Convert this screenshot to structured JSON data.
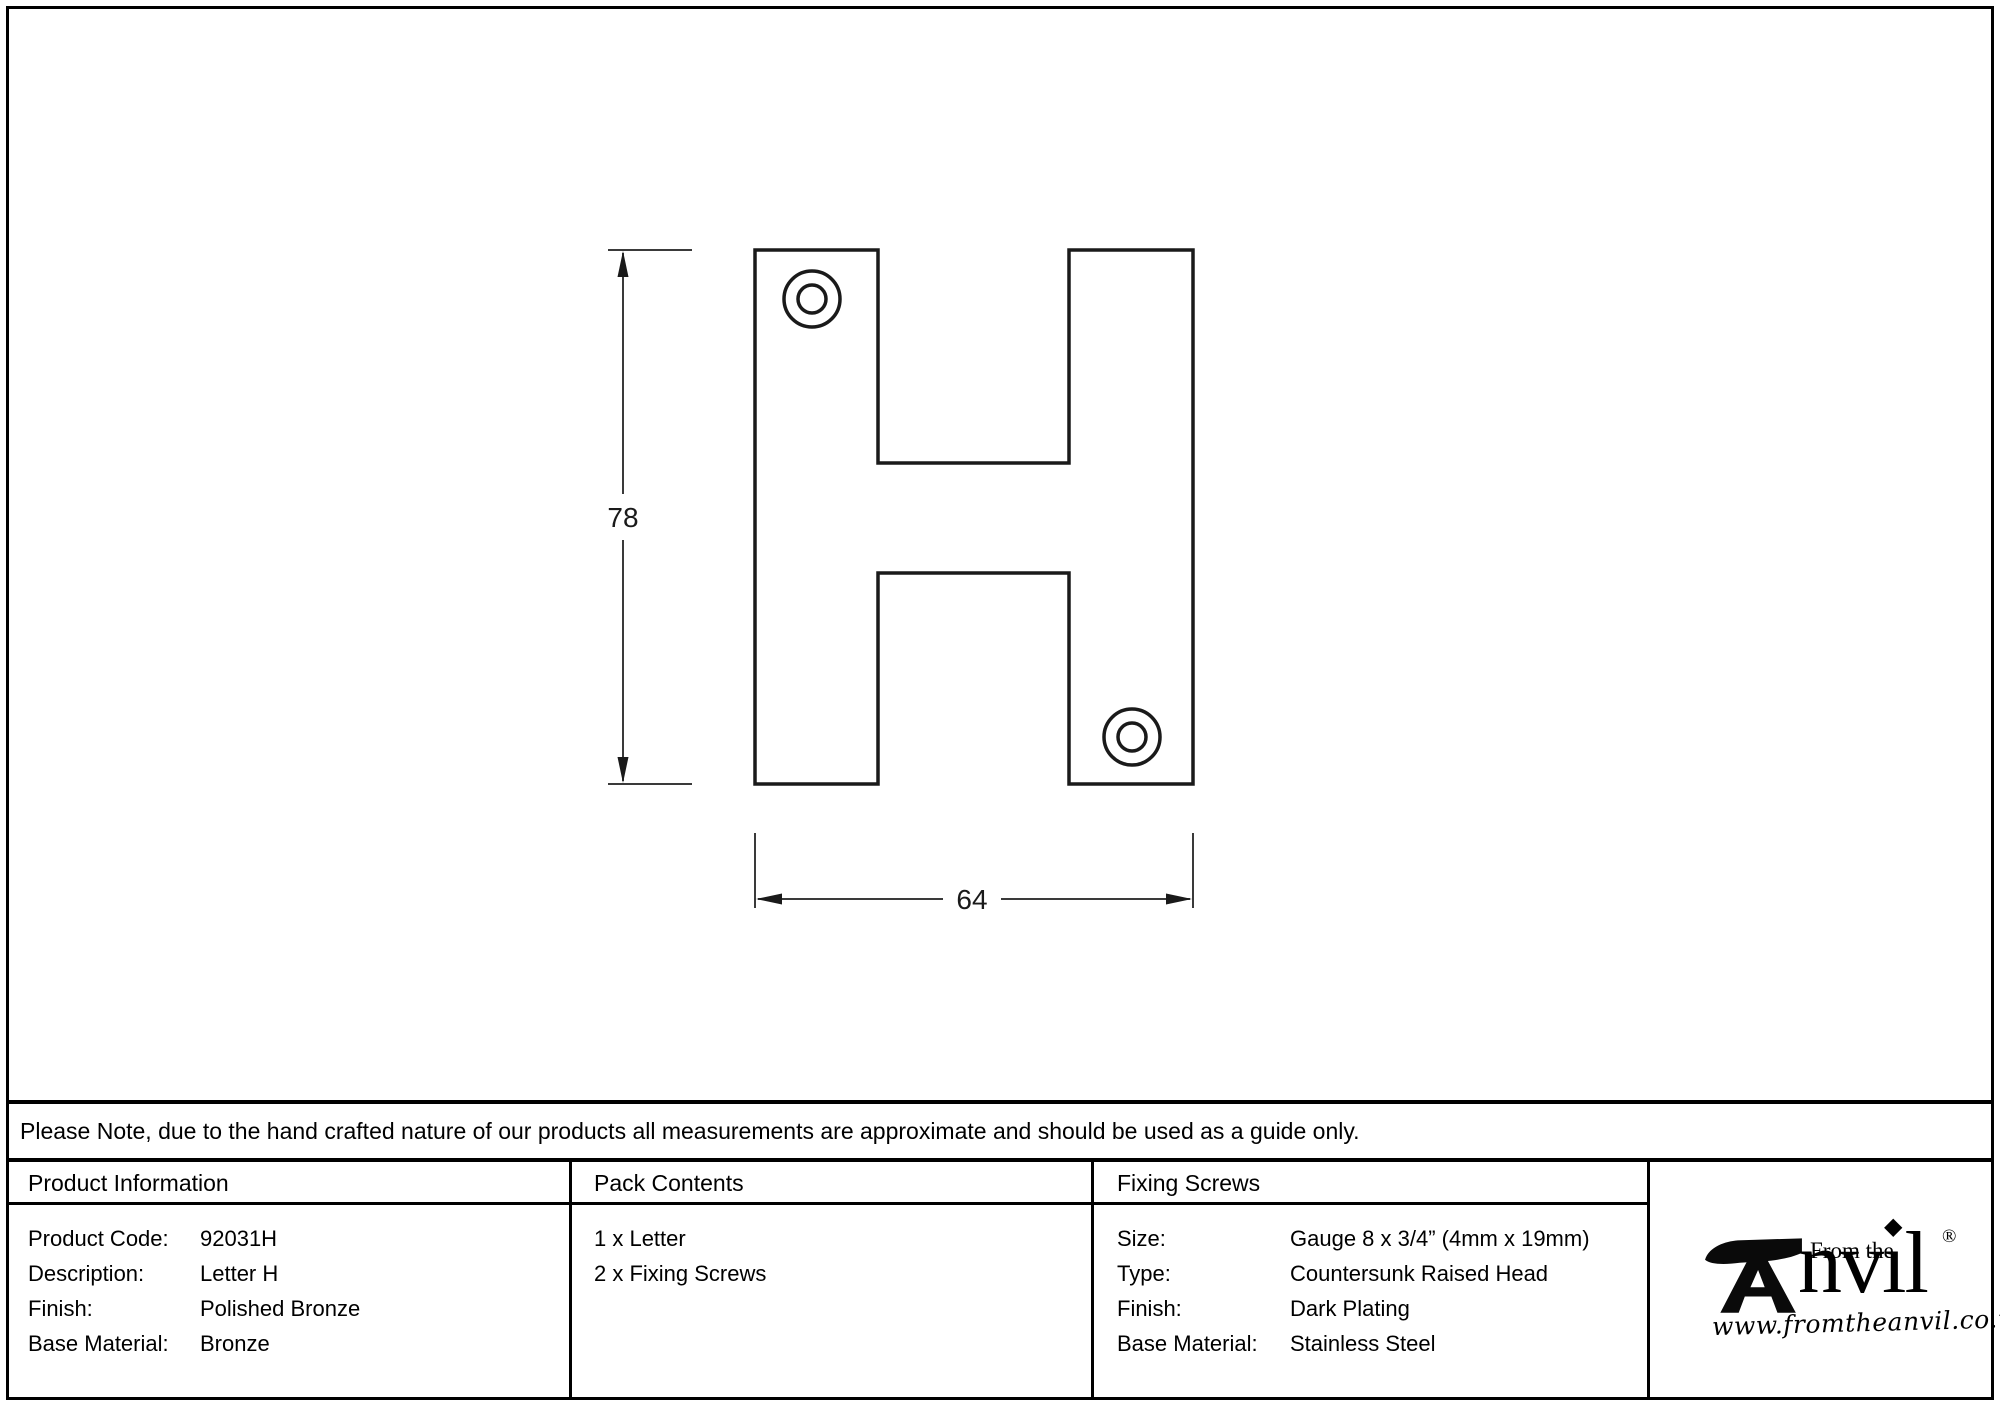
{
  "page": {
    "background": "#ffffff",
    "border_color": "#000000",
    "ink_color": "#1a1a1a"
  },
  "drawing": {
    "part": "letter-H-fascia",
    "height_dim": "78",
    "width_dim": "64",
    "screw_hole_count": 2
  },
  "note": {
    "text": "Please Note, due to the hand crafted nature of our products all measurements are approximate and should be used as a guide only."
  },
  "table": {
    "product_information": {
      "header": "Product Information",
      "rows": [
        {
          "label": "Product Code:",
          "value": "92031H"
        },
        {
          "label": "Description:",
          "value": "Letter H"
        },
        {
          "label": "Finish:",
          "value": "Polished Bronze"
        },
        {
          "label": "Base Material:",
          "value": "Bronze"
        }
      ]
    },
    "pack_contents": {
      "header": "Pack Contents",
      "items": [
        "1 x Letter",
        "2 x Fixing Screws"
      ]
    },
    "fixing_screws": {
      "header": "Fixing Screws",
      "rows": [
        {
          "label": "Size:",
          "value": "Gauge 8 x 3/4” (4mm x 19mm)"
        },
        {
          "label": "Type:",
          "value": "Countersunk Raised Head"
        },
        {
          "label": "Finish:",
          "value": "Dark Plating"
        },
        {
          "label": "Base Material:",
          "value": "Stainless Steel"
        }
      ]
    }
  },
  "logo": {
    "tagline": "From the",
    "brand_prefix": "nv",
    "brand_dotless_i": "ı",
    "brand_tittle": "◆",
    "brand_suffix": "l",
    "registered": "®",
    "website": "www.fromtheanvil.co.uk"
  }
}
